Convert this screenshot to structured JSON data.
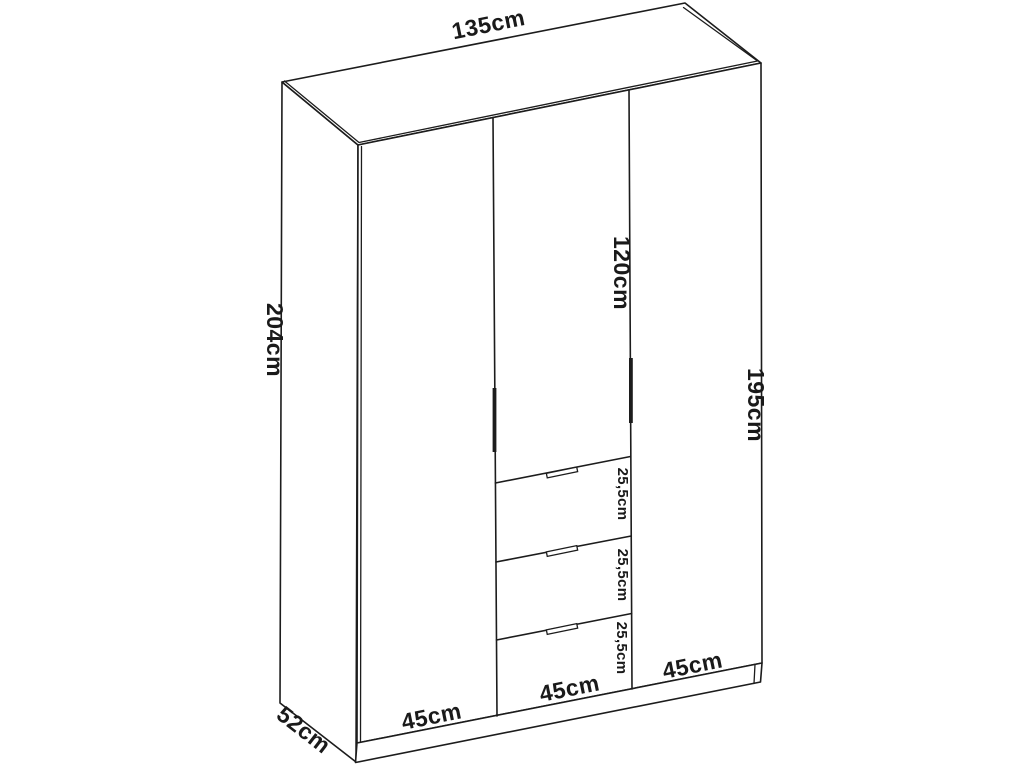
{
  "diagram": {
    "name": "three-door-wardrobe-dimension-drawing",
    "colors": {
      "line": "#1c1c1c",
      "text": "#1a1a1a",
      "background": "#ffffff"
    },
    "dimensions": {
      "total_width": "135cm",
      "total_height": "204cm",
      "total_depth": "52cm",
      "middle_door_height": "120cm",
      "door_height": "195cm",
      "drawer1_height": "25,5cm",
      "drawer2_height": "25,5cm",
      "drawer3_height": "25,5cm",
      "left_door_width": "45cm",
      "middle_door_width": "45cm",
      "right_door_width": "45cm"
    }
  }
}
